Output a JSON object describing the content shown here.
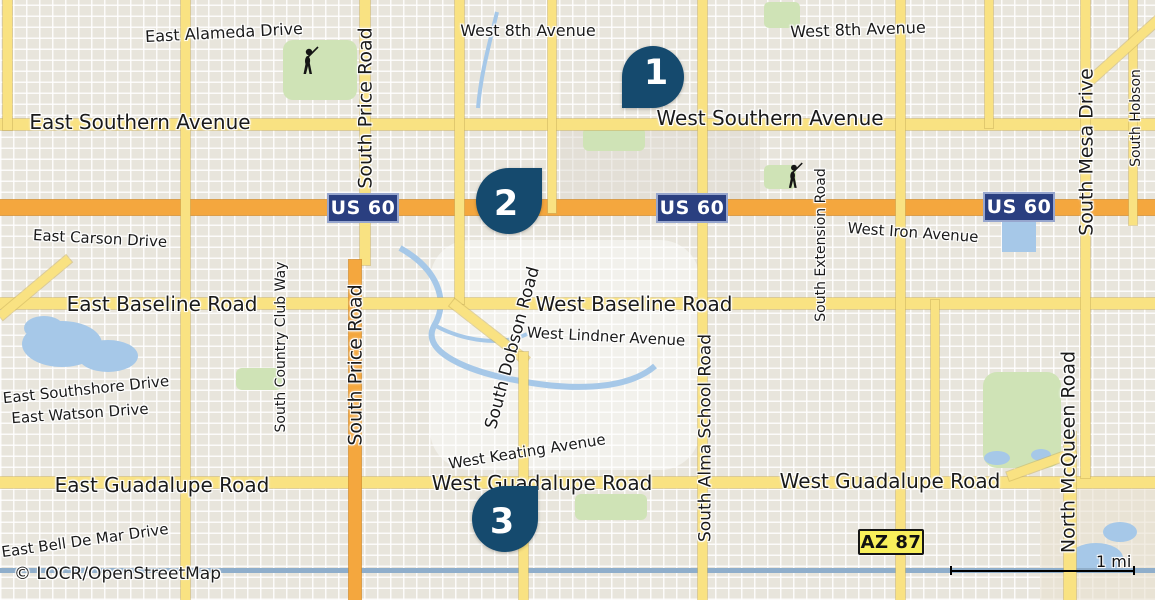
{
  "map": {
    "attribution": "© LOCR/OpenStreetMap",
    "scale": {
      "label": "1 mi"
    },
    "colors": {
      "bg": "#E8E5DC",
      "arterial": "#F9E282",
      "highway": "#F4A73E",
      "navy": "#154A6E",
      "shieldblue": "#2A3F80",
      "azyellow": "#F8EF5B",
      "water": "#A6C8E8",
      "green": "#CFE3B6"
    },
    "markers": [
      {
        "number": "1",
        "x": 622,
        "y": 46,
        "size": 62,
        "tip": "bl"
      },
      {
        "number": "2",
        "x": 476,
        "y": 168,
        "size": 66,
        "tip": "tr"
      },
      {
        "number": "3",
        "x": 472,
        "y": 486,
        "size": 66,
        "tip": "tr"
      }
    ],
    "shields": [
      {
        "type": "us60",
        "label": "US 60",
        "x": 327,
        "y": 193
      },
      {
        "type": "us60",
        "label": "US 60",
        "x": 656,
        "y": 193
      },
      {
        "type": "us60",
        "label": "US 60",
        "x": 983,
        "y": 192
      },
      {
        "type": "az87",
        "label": "AZ 87",
        "x": 858,
        "y": 529
      }
    ],
    "roads": [
      {
        "x": 0,
        "y": 119,
        "w": 1155,
        "h": 11,
        "kind": "arterial"
      },
      {
        "x": 0,
        "y": 298,
        "w": 1155,
        "h": 11,
        "kind": "arterial"
      },
      {
        "x": 0,
        "y": 477,
        "w": 1155,
        "h": 11,
        "kind": "arterial"
      },
      {
        "x": 0,
        "y": 200,
        "w": 1155,
        "h": 15,
        "kind": "highway"
      },
      {
        "x": 3,
        "y": 0,
        "w": 9,
        "h": 130,
        "kind": "arterial"
      },
      {
        "x": 181,
        "y": 0,
        "w": 9,
        "h": 600,
        "kind": "arterial"
      },
      {
        "x": 360,
        "y": 0,
        "w": 10,
        "h": 265,
        "kind": "arterial"
      },
      {
        "x": 349,
        "y": 260,
        "w": 12,
        "h": 340,
        "kind": "highway"
      },
      {
        "x": 455,
        "y": 0,
        "w": 9,
        "h": 304,
        "kind": "arterial"
      },
      {
        "x": 452,
        "y": 298,
        "w": 95,
        "h": 9,
        "rot": 38,
        "kind": "arterial"
      },
      {
        "x": 519,
        "y": 352,
        "w": 9,
        "h": 248,
        "kind": "arterial"
      },
      {
        "x": 548,
        "y": 0,
        "w": 8,
        "h": 213,
        "kind": "arterial"
      },
      {
        "x": 698,
        "y": 0,
        "w": 9,
        "h": 600,
        "kind": "arterial"
      },
      {
        "x": 896,
        "y": 0,
        "w": 9,
        "h": 600,
        "kind": "arterial"
      },
      {
        "x": 985,
        "y": 0,
        "w": 8,
        "h": 128,
        "kind": "arterial"
      },
      {
        "x": 931,
        "y": 300,
        "w": 8,
        "h": 182,
        "kind": "arterial"
      },
      {
        "x": 1081,
        "y": 0,
        "w": 9,
        "h": 478,
        "kind": "arterial"
      },
      {
        "x": 1064,
        "y": 432,
        "w": 12,
        "h": 168,
        "kind": "arterial"
      },
      {
        "x": 1129,
        "y": 0,
        "w": 8,
        "h": 225,
        "kind": "arterial"
      },
      {
        "x": 0,
        "y": 312,
        "w": 90,
        "h": 9,
        "rot": -40,
        "kind": "arterial"
      },
      {
        "x": 1086,
        "y": 80,
        "w": 100,
        "h": 9,
        "rot": -42,
        "kind": "arterial"
      },
      {
        "x": 1008,
        "y": 472,
        "w": 72,
        "h": 9,
        "rot": -20,
        "kind": "arterial"
      }
    ],
    "road_labels": [
      {
        "text": "East Alameda Drive",
        "x": 224,
        "y": 33,
        "fs": 16,
        "rot": -3
      },
      {
        "text": "West 8th Avenue",
        "x": 528,
        "y": 31,
        "fs": 16,
        "rot": 0
      },
      {
        "text": "West 8th Avenue",
        "x": 858,
        "y": 30,
        "fs": 16,
        "rot": -2
      },
      {
        "text": "East Southern Avenue",
        "x": 140,
        "y": 122,
        "fs": 20,
        "rot": 0
      },
      {
        "text": "West Southern Avenue",
        "x": 770,
        "y": 118,
        "fs": 20,
        "rot": 0
      },
      {
        "text": "East Carson Drive",
        "x": 100,
        "y": 239,
        "fs": 15,
        "rot": 3
      },
      {
        "text": "West Iron Avenue",
        "x": 913,
        "y": 233,
        "fs": 15,
        "rot": 4
      },
      {
        "text": "East Baseline Road",
        "x": 162,
        "y": 304,
        "fs": 20,
        "rot": 0
      },
      {
        "text": "West Baseline Road",
        "x": 634,
        "y": 304,
        "fs": 20,
        "rot": 0
      },
      {
        "text": "West Lindner Avenue",
        "x": 606,
        "y": 337,
        "fs": 15,
        "rot": 3
      },
      {
        "text": "East Southshore Drive",
        "x": 86,
        "y": 390,
        "fs": 15,
        "rot": -6
      },
      {
        "text": "East Watson Drive",
        "x": 80,
        "y": 414,
        "fs": 15,
        "rot": -4
      },
      {
        "text": "West Keating Avenue",
        "x": 527,
        "y": 452,
        "fs": 15,
        "rot": -9
      },
      {
        "text": "East Guadalupe Road",
        "x": 162,
        "y": 485,
        "fs": 20,
        "rot": 0
      },
      {
        "text": "West Guadalupe Road",
        "x": 542,
        "y": 483,
        "fs": 20,
        "rot": 0
      },
      {
        "text": "West Guadalupe Road",
        "x": 890,
        "y": 481,
        "fs": 20,
        "rot": 0
      },
      {
        "text": "East Bell De Mar Drive",
        "x": 85,
        "y": 541,
        "fs": 15,
        "rot": -8
      },
      {
        "text": "South Price Road",
        "x": 366,
        "y": 108,
        "fs": 19,
        "rot": -90
      },
      {
        "text": "South Price Road",
        "x": 356,
        "y": 365,
        "fs": 19,
        "rot": -90
      },
      {
        "text": "South Country Club Way",
        "x": 281,
        "y": 347,
        "fs": 14,
        "rot": -90
      },
      {
        "text": "South Dobson Road",
        "x": 513,
        "y": 348,
        "fs": 17,
        "rot": -75
      },
      {
        "text": "South Alma School Road",
        "x": 706,
        "y": 438,
        "fs": 17,
        "rot": -90
      },
      {
        "text": "South Extension Road",
        "x": 821,
        "y": 245,
        "fs": 14,
        "rot": -90
      },
      {
        "text": "South Mesa Drive",
        "x": 1087,
        "y": 152,
        "fs": 19,
        "rot": -90
      },
      {
        "text": "South Hobson",
        "x": 1136,
        "y": 118,
        "fs": 14,
        "rot": -90
      },
      {
        "text": "North McQueen Road",
        "x": 1069,
        "y": 452,
        "fs": 19,
        "rot": -90
      }
    ],
    "icons": [
      {
        "name": "golfer-icon",
        "x": 296,
        "y": 48
      },
      {
        "name": "golfer-icon",
        "x": 782,
        "y": 164
      }
    ]
  }
}
